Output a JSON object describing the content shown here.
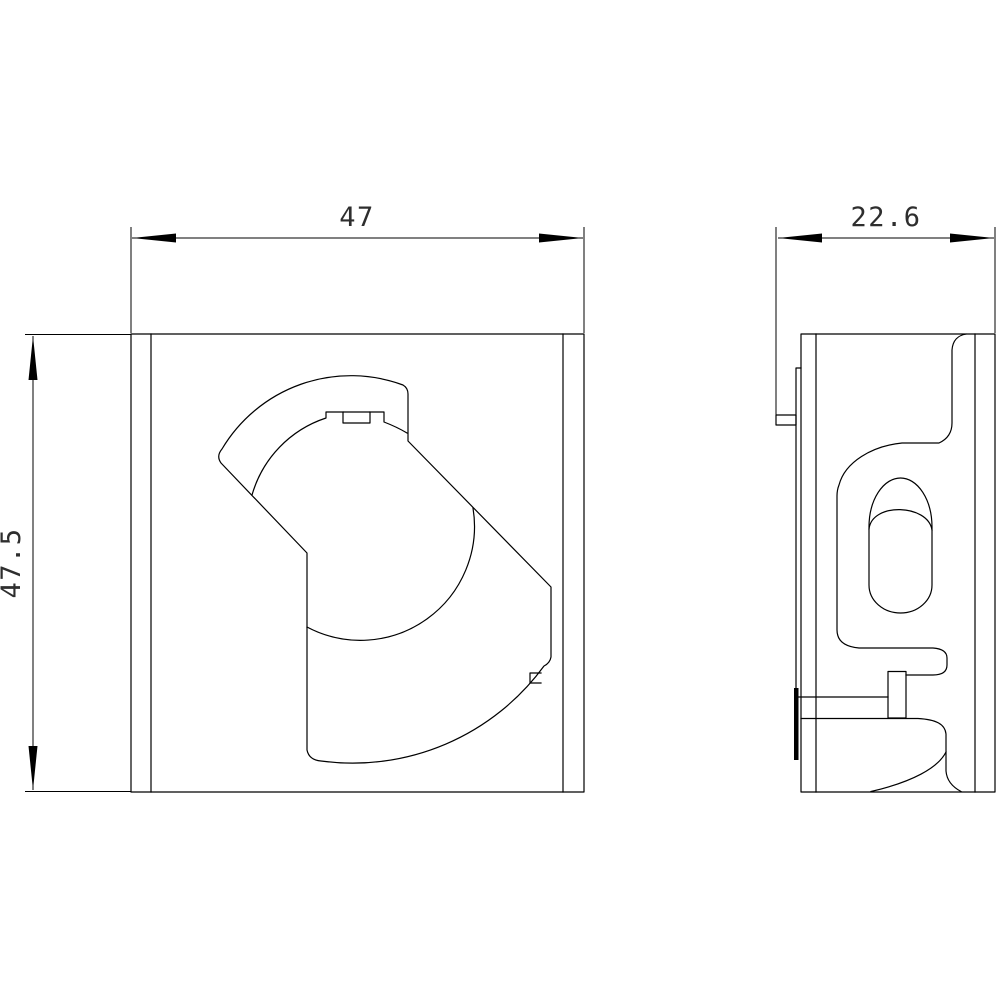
{
  "drawing": {
    "kind": "technical-dimension-drawing",
    "background_color": "#ffffff",
    "line_color": "#000000",
    "dim_text_color": "#2e2e2e",
    "views": {
      "front_view": {
        "description": "front view of padlock cam lever block"
      },
      "side_view": {
        "description": "side profile view with DIN-rail clip"
      }
    },
    "dimensions": {
      "front_width": "47",
      "front_height": "47.5",
      "side_width": "22.6"
    }
  }
}
